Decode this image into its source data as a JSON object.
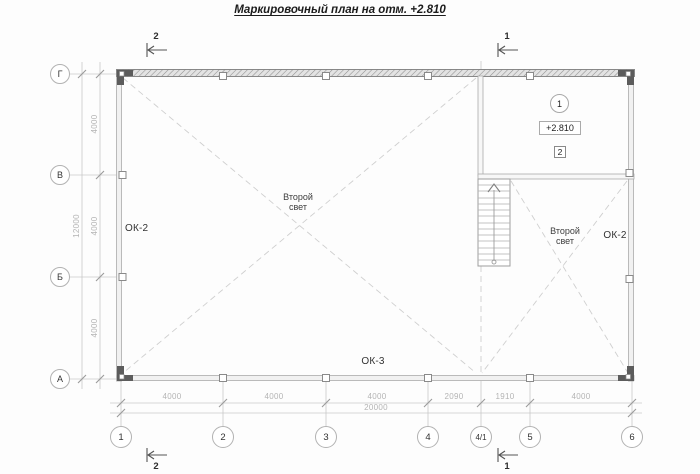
{
  "title": "Маркировочный план на отм. +2.810",
  "grid": {
    "row_axes": [
      "Г",
      "В",
      "Б",
      "А"
    ],
    "col_axes": [
      "1",
      "2",
      "3",
      "4",
      "4/1",
      "5",
      "6"
    ]
  },
  "dims": {
    "left_segments": [
      "4000",
      "4000",
      "4000"
    ],
    "left_total": "12000",
    "bottom_segments": [
      "4000",
      "4000",
      "4000",
      "2090",
      "1910",
      "4000"
    ],
    "bottom_total": "20000"
  },
  "sections": {
    "top_left": "2",
    "top_right": "1",
    "bottom_left": "2",
    "bottom_right": "1"
  },
  "labels": {
    "window_left": "ОК-2",
    "window_right": "ОК-2",
    "window_bottom": "ОК-3",
    "void_line1": "Второй",
    "void_line2": "свет"
  },
  "room_markers": {
    "circle": "1",
    "elevation": "+2.810",
    "square": "2"
  },
  "colors": {
    "paper": "#fdfdfd",
    "wall_line": "#ababab",
    "wall_fill": "#f1f1f1",
    "hatch": "#8f8f8f",
    "light_line": "#c9c9c9",
    "dash_line": "#cfcfcf",
    "dim_text": "#b4b4b4",
    "dark_text": "#333333",
    "corner_column": "#5c5c5c",
    "stair_line": "#9e9e9e"
  }
}
